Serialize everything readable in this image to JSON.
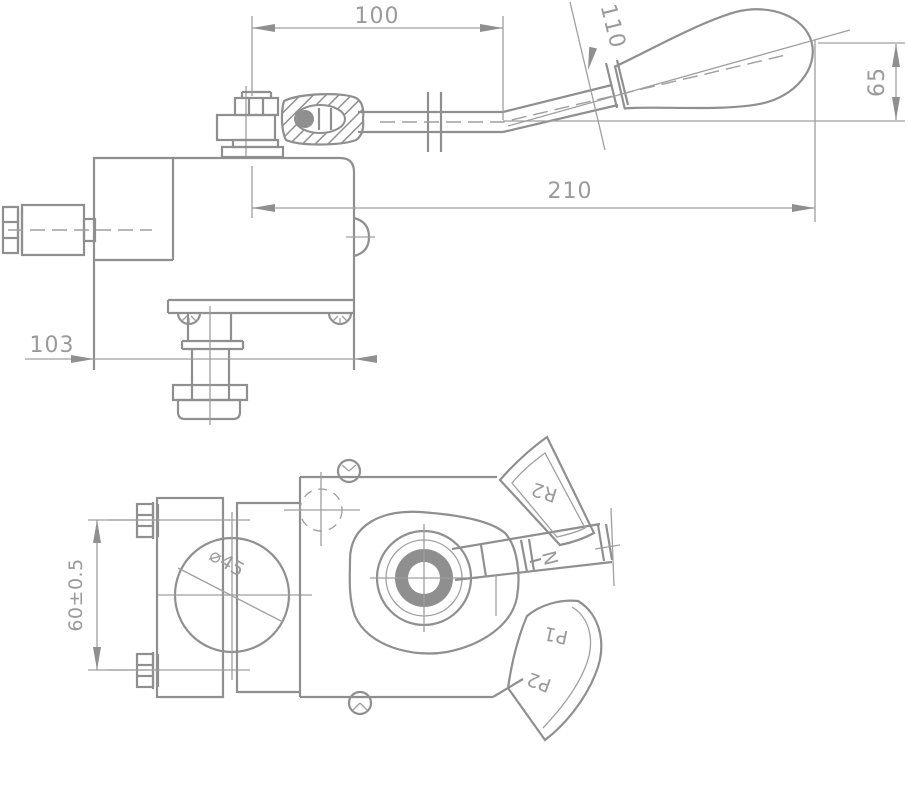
{
  "drawing": {
    "background": "#ffffff",
    "line_color": "#8f8f8f",
    "text_color": "#9a9a9a",
    "views": {
      "side_view": {
        "dimensions": {
          "lever_pivot_offset": "100",
          "handle_length": "110",
          "handle_tip_height": "65",
          "overall_reach": "210",
          "body_width": "103"
        }
      },
      "plan_view": {
        "dimensions": {
          "bolt_spacing": "60±0.5",
          "bore_diameter": "⌀45"
        },
        "position_labels": {
          "reverse_2": "R2",
          "neutral": "N",
          "forward_1": "P1",
          "forward_2": "P2"
        }
      }
    }
  }
}
